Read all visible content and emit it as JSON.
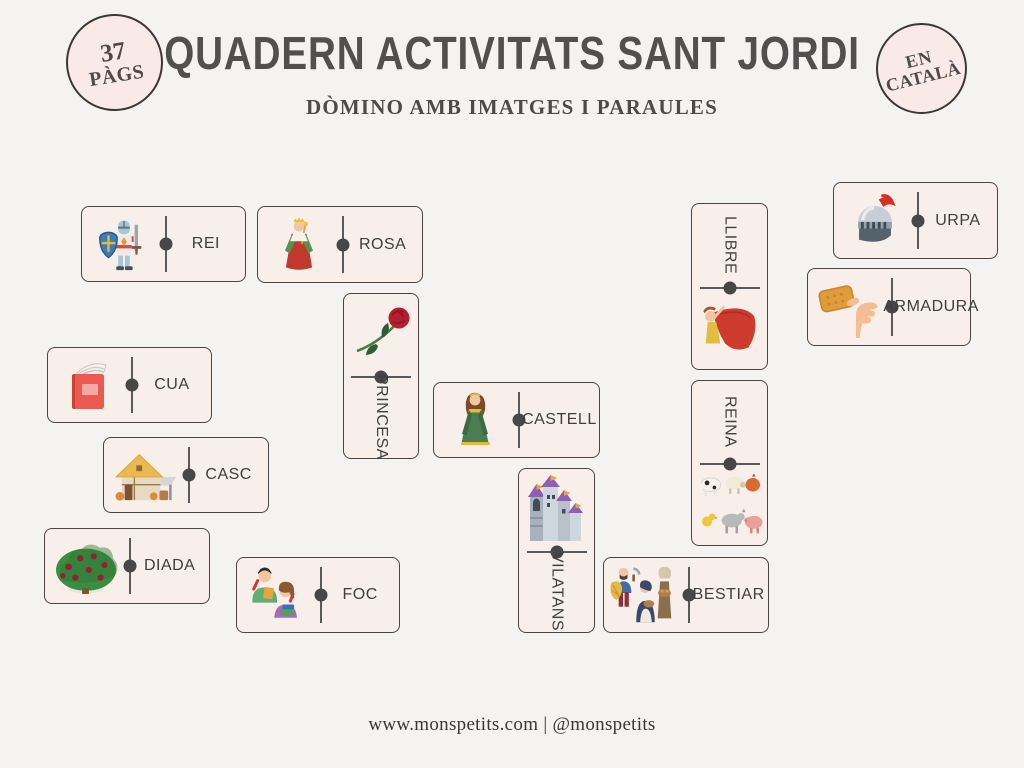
{
  "page": {
    "background": "#f4f3f1"
  },
  "header": {
    "badge_left": {
      "line1": "37",
      "line2": "PÀGS"
    },
    "title": "QUADERN ACTIVITATS SANT JORDI",
    "badge_right": {
      "line1": "EN",
      "line2": "CATALÀ"
    },
    "subtitle": "DÒMINO AMB IMATGES I PARAULES"
  },
  "tiles": [
    {
      "label": "REI",
      "icon": "knight-icon",
      "orientation": "horizontal"
    },
    {
      "label": "ROSA",
      "icon": "king-red-robe-icon",
      "orientation": "horizontal"
    },
    {
      "label": "PRINCESA",
      "icon": "rose-icon",
      "orientation": "vertical-image-top"
    },
    {
      "label": "CUA",
      "icon": "red-book-icon",
      "orientation": "horizontal"
    },
    {
      "label": "CASC",
      "icon": "medieval-house-icon",
      "orientation": "horizontal"
    },
    {
      "label": "DIADA",
      "icon": "rose-bush-icon",
      "orientation": "horizontal"
    },
    {
      "label": "FOC",
      "icon": "reading-couple-icon",
      "orientation": "horizontal"
    },
    {
      "label": "CASTELL",
      "icon": "green-princess-icon",
      "orientation": "horizontal"
    },
    {
      "label": "VILATANS",
      "icon": "castle-icon",
      "orientation": "vertical-image-top"
    },
    {
      "label": "BESTIAR",
      "icon": "villagers-icon",
      "orientation": "horizontal"
    },
    {
      "label": "LLIBRE",
      "icon": "red-cape-lady-icon",
      "orientation": "vertical-text-top"
    },
    {
      "label": "REINA",
      "icon": "farm-animals-icon",
      "orientation": "vertical-text-top"
    },
    {
      "label": "URPA",
      "icon": "knight-helmet-icon",
      "orientation": "horizontal"
    },
    {
      "label": "ARMADURA",
      "icon": "hand-with-biscuit-icon",
      "orientation": "horizontal"
    }
  ],
  "footer": {
    "text": "www.monspetits.com | @monspetits"
  },
  "colors": {
    "tile_bg": "#f8efeb",
    "tile_border": "#4a4442",
    "badge_bg": "#f9eae8",
    "text": "#4a4a4b",
    "divider": "#5a5a5a"
  }
}
